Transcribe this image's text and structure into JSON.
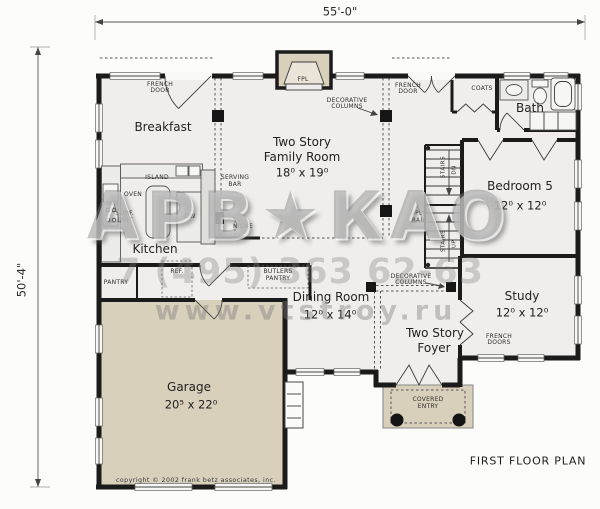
{
  "dimensions": {
    "top": "55'-0\"",
    "left": "50'-4\""
  },
  "rooms": {
    "breakfast": {
      "name": "Breakfast"
    },
    "family_room": {
      "name1": "Two Story",
      "name2": "Family Room",
      "size": "18⁰ x 19⁰"
    },
    "kitchen": {
      "name": "Kitchen"
    },
    "dining_room": {
      "name": "Dining Room",
      "size": "12⁰ x 14⁰"
    },
    "foyer": {
      "name1": "Two Story",
      "name2": "Foyer"
    },
    "bedroom5": {
      "name": "Bedroom 5",
      "size": "12⁰ x 12⁰"
    },
    "study": {
      "name": "Study",
      "size": "12⁰ x 12⁰"
    },
    "bath": {
      "name": "Bath"
    },
    "garage": {
      "name": "Garage",
      "size": "20⁵ x 22⁰"
    }
  },
  "labels": {
    "french_door": [
      "FRENCH",
      "DOOR"
    ],
    "french_doors": [
      "FRENCH",
      "DOORS"
    ],
    "decorative_columns": [
      "DECORATIVE",
      "COLUMNS"
    ],
    "coats": "COATS",
    "island": "ISLAND",
    "oven": "OVEN",
    "surface_unit": [
      "SURF.",
      "UNIT"
    ],
    "dw": "DW",
    "serving_bar": [
      "SERVING",
      "BAR"
    ],
    "niche": "NICHE",
    "pantry": "PANTRY",
    "ref": "REF.",
    "butlers_pantry": [
      "BUTLERS",
      "PANTRY"
    ],
    "fpl": "FPL",
    "stairs": "STAIRS",
    "dn": "DN",
    "up": "UP",
    "open_rail": [
      "OPEN",
      "RAIL"
    ],
    "covered_entry": [
      "COVERED",
      "ENTRY"
    ]
  },
  "footer": {
    "title": "FIRST FLOOR PLAN",
    "copyright": "copyright © 2002 frank betz associates, inc."
  },
  "watermark": {
    "logo_left": "АРВ",
    "figure": "★",
    "logo_right": "КАО",
    "phone": "7 (495) 363 62-63",
    "site": "www.vtstroy.ru"
  },
  "colors": {
    "wall": "#1b1b1b",
    "floor": "#efeeec",
    "tan": "#d9d0bb",
    "watermark": "#808080"
  }
}
